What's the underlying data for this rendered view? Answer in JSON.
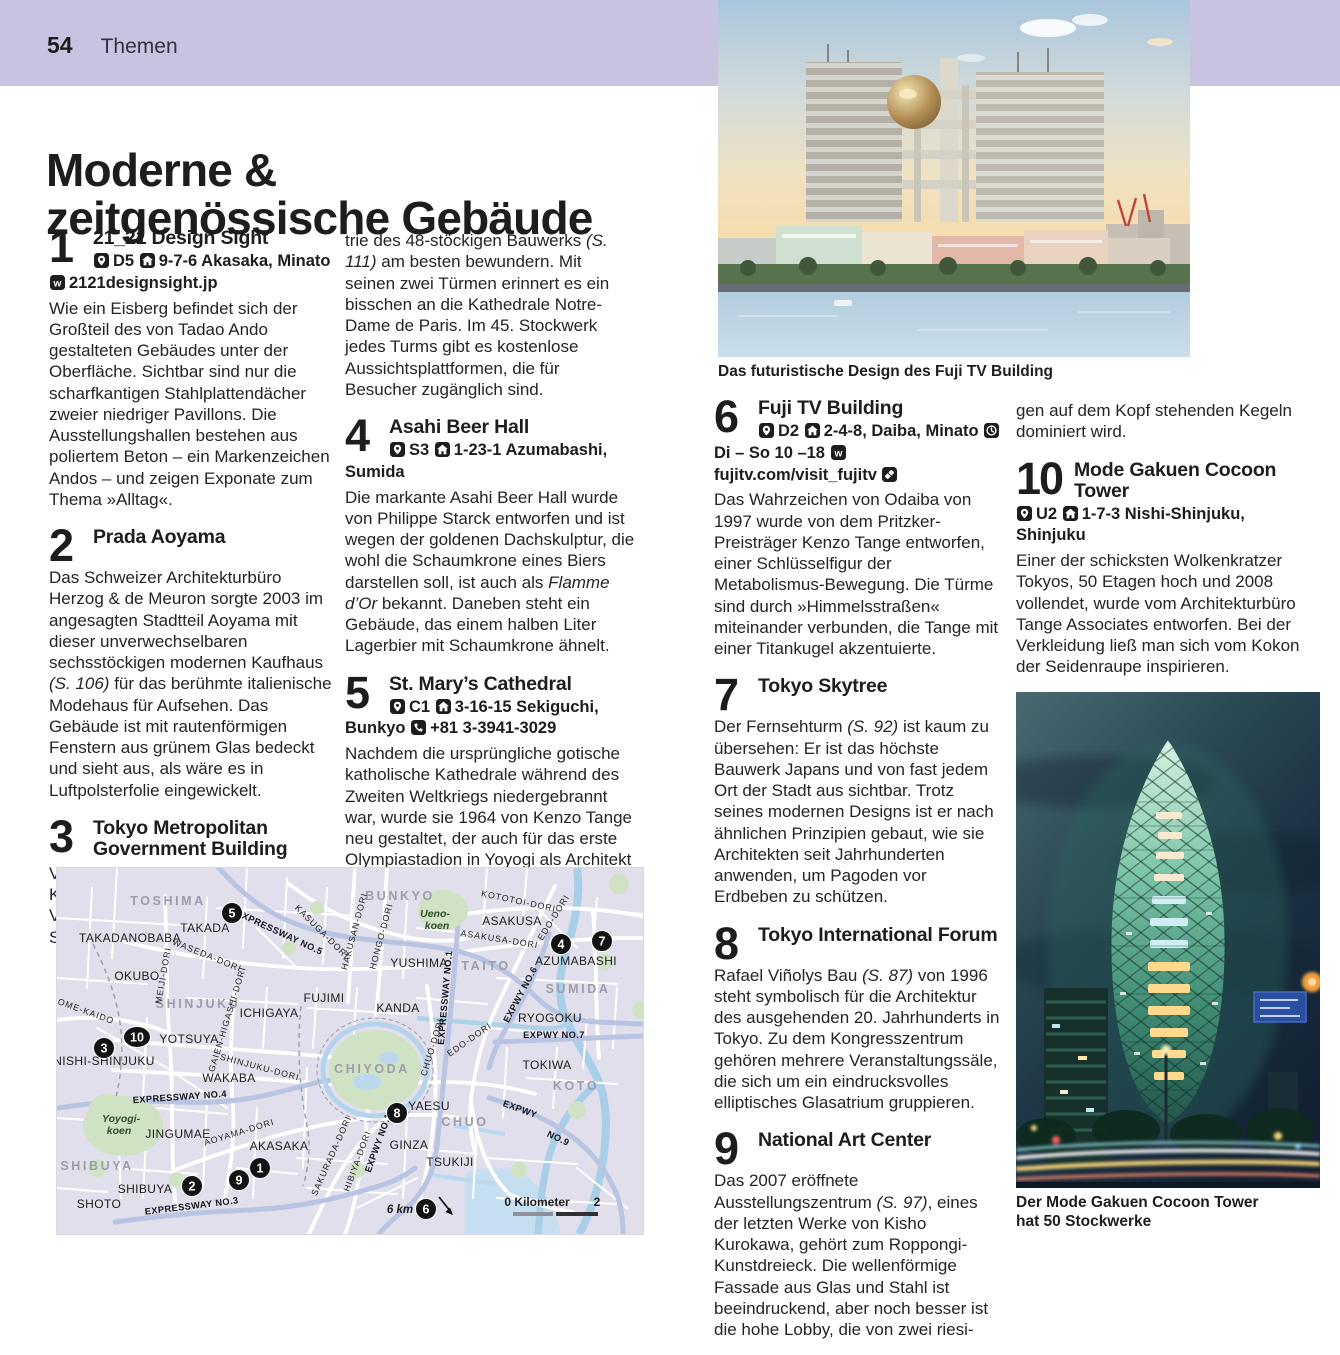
{
  "header": {
    "page_number": "54",
    "section_label": "Themen"
  },
  "title": {
    "line1": "Moderne &",
    "line2": "zeitgenössische Gebäude"
  },
  "captions": {
    "photo1": "Das futuristische Design des Fuji TV Building",
    "photo2": "Der Mode Gakuen Cocoon Tower hat 50 Stockwerke"
  },
  "colors": {
    "band": "#c9c3e2",
    "text": "#1d1d1b",
    "map_background": "#e0dfeb",
    "map_park": "#cfe3c4",
    "map_water": "#a9cfe8",
    "map_expressway": "#b9c4e2",
    "map_road": "#ffffff",
    "marker": "#131313"
  },
  "entries": {
    "e1": {
      "number": "1",
      "title": "21_21 Design Sight",
      "info": [
        {
          "icon": "map-pin-icon",
          "text": "D5"
        },
        {
          "icon": "house-icon",
          "text": "9-7-6 Akasaka, Minato"
        },
        {
          "icon": "web-icon",
          "text": "2121designsight.jp"
        }
      ],
      "body": "Wie ein Eisberg befindet sich der Großteil des von Tadao Ando gestalteten Gebäudes unter der Oberfläche. Sichtbar sind nur die scharfkantigen Stahlplattendächer zweier niedriger Pavillons. Die Ausstellungshallen bestehen aus poliertem Beton – ein Markenzeichen Andos – und zeigen Exponate zum Thema »Alltag«."
    },
    "e2": {
      "number": "2",
      "title": "Prada Aoyama",
      "body": "Das Schweizer Architekturbüro Herzog & de Meuron sorgte 2003 im angesagten Stadtteil Aoyama mit dieser unverwechselbaren sechsstöckigen modernen Kaufhaus (S. 106) für das berühmte italienische Modehaus für Aufsehen. Das Gebäude ist mit rautenförmigen Fenstern aus grünem Glas bedeckt und sieht aus, als wäre es in Luftpolsterfolie eingewickelt."
    },
    "e3": {
      "number": "3",
      "title": "Tokyo Metropolitan Government Building",
      "body": "Vom Rand der Plaza vor dem von Kenzo Tange entworfenen Verwaltungsgebäude lässt sich die Symme-"
    },
    "cont2": "trie des 48-stöckigen Bauwerks (S. 111) am besten bewundern. Mit seinen zwei Türmen erinnert es ein bisschen an die Kathedrale Notre-Dame de Paris. Im 45. Stockwerk jedes Turms gibt es kostenlose Aussichtsplattformen, die für Besucher zugänglich sind.",
    "e4": {
      "number": "4",
      "title": "Asahi Beer Hall",
      "info": [
        {
          "icon": "map-pin-icon",
          "text": "S3"
        },
        {
          "icon": "house-icon",
          "text": "1-23-1 Azumabashi, Sumida"
        }
      ],
      "body": "Die markante Asahi Beer Hall wurde von Philippe Starck entworfen und ist wegen der goldenen Dachskulptur, die wohl die Schaumkrone eines Biers darstellen soll, ist auch als Flamme d’Or bekannt. Daneben steht ein Gebäude, das einem halben Liter Lagerbier mit Schaumkrone ähnelt."
    },
    "e5": {
      "number": "5",
      "title": "St. Mary’s Cathedral",
      "info": [
        {
          "icon": "map-pin-icon",
          "text": "C1"
        },
        {
          "icon": "house-icon",
          "text": "3-16-15 Sekiguchi, Bunkyo"
        },
        {
          "icon": "phone-icon",
          "text": "+81 3-3941-3029"
        }
      ],
      "body": "Nachdem die ursprüngliche gotische katholische Kathedrale während des Zweiten Weltkriegs niedergebrannt war, wurde sie 1964 von Kenzo Tange neu gestaltet, der auch für das erste Olympiastadion in Yoyogi als Architekt verantwortlich zeichnete."
    },
    "e6": {
      "number": "6",
      "title": "Fuji TV Building",
      "info": [
        {
          "icon": "map-pin-icon",
          "text": "D2"
        },
        {
          "icon": "house-icon",
          "text": "2-4-8, Daiba, Minato"
        },
        {
          "icon": "clock-icon",
          "text": "Di – So 10 –18"
        },
        {
          "icon": "web-icon",
          "text": "fujitv.com/visit_fujitv"
        },
        {
          "icon": "ticket-icon",
          "text": ""
        }
      ],
      "body": "Das Wahrzeichen von Odaiba von 1997 wurde von dem Pritzker-Preisträger Kenzo Tange entworfen, einer Schlüsselfigur der Metabolismus-Bewegung. Die Türme sind durch »Himmelsstraßen« miteinander verbunden, die Tange mit einer Titankugel akzentuierte."
    },
    "e7": {
      "number": "7",
      "title": "Tokyo Skytree",
      "body": "Der Fernsehturm (S. 92) ist kaum zu übersehen: Er ist das höchste Bauwerk Japans und von fast jedem Ort der Stadt aus sichtbar. Trotz seines modernen Designs ist er nach ähnlichen Prinzipien gebaut, wie sie Architekten seit Jahrhunderten anwenden, um Pagoden vor Erdbeben zu schützen."
    },
    "e8": {
      "number": "8",
      "title": "Tokyo International Forum",
      "body": "Rafael Viñolys Bau (S. 87) von 1996 steht symbolisch für die Architektur des ausgehenden 20. Jahrhunderts in Tokyo. Zu dem Kongresszentrum gehören mehrere Veranstaltungssäle, die sich um ein eindrucksvolles elliptisches Glasatrium gruppieren."
    },
    "e9": {
      "number": "9",
      "title": "National Art Center",
      "body": "Das 2007 eröffnete Ausstellungszentrum (S. 97), eines der letzten Werke von Kisho Kurokawa, gehört zum Roppongi-Kunstdreieck. Die wellenförmige Fassade aus Glas und Stahl ist beeindruckend, aber noch besser ist die hohe Lobby, die von zwei riesi-"
    },
    "cont4": "gen auf dem Kopf stehenden Kegeln dominiert wird.",
    "e10": {
      "number": "10",
      "title": "Mode Gakuen Cocoon Tower",
      "info": [
        {
          "icon": "map-pin-icon",
          "text": "U2"
        },
        {
          "icon": "house-icon",
          "text": "1-7-3 Nishi-Shinjuku, Shinjuku"
        }
      ],
      "body": "Einer der schicksten Wolkenkratzer Tokyos, 50 Etagen hoch und 2008 vollendet, wurde vom Architekturbüro Tange Associates entworfen. Bei der Verkleidung ließ man sich vom Kokon der Seidenraupe inspirieren."
    }
  },
  "map": {
    "markers": [
      {
        "n": "1",
        "x": 203,
        "y": 300
      },
      {
        "n": "2",
        "x": 135,
        "y": 318
      },
      {
        "n": "3",
        "x": 47,
        "y": 180
      },
      {
        "n": "4",
        "x": 504,
        "y": 76
      },
      {
        "n": "5",
        "x": 175,
        "y": 45
      },
      {
        "n": "6",
        "x": 369,
        "y": 341
      },
      {
        "n": "7",
        "x": 545,
        "y": 73
      },
      {
        "n": "8",
        "x": 340,
        "y": 245
      },
      {
        "n": "9",
        "x": 182,
        "y": 312
      },
      {
        "n": "10",
        "x": 80,
        "y": 169
      }
    ],
    "labels": [
      {
        "text": "TOSHIMA",
        "type": "district",
        "x": 111,
        "y": 37,
        "r": 0
      },
      {
        "text": "BUNKYO",
        "type": "district",
        "x": 343,
        "y": 32,
        "r": 0
      },
      {
        "text": "SHINJUKU",
        "type": "district",
        "x": 141,
        "y": 140,
        "r": 0
      },
      {
        "text": "TAITO",
        "type": "district",
        "x": 429,
        "y": 102,
        "r": 0
      },
      {
        "text": "SUMIDA",
        "type": "district",
        "x": 521,
        "y": 125,
        "r": 0
      },
      {
        "text": "CHIYODA",
        "type": "district",
        "x": 315,
        "y": 205,
        "r": 0
      },
      {
        "text": "SHIBUYA",
        "type": "district",
        "x": 40,
        "y": 302,
        "r": 0
      },
      {
        "text": "CHUO",
        "type": "district",
        "x": 408,
        "y": 258,
        "r": 0
      },
      {
        "text": "KOTO",
        "type": "district",
        "x": 519,
        "y": 222,
        "r": 0
      },
      {
        "text": "TAKADANOBABA",
        "type": "place",
        "x": 73,
        "y": 74,
        "r": 0
      },
      {
        "text": "TAKADA",
        "type": "place",
        "x": 148,
        "y": 64,
        "r": 0
      },
      {
        "text": "OKUBO",
        "type": "place",
        "x": 80,
        "y": 112,
        "r": 0
      },
      {
        "text": "YUSHIMA",
        "type": "place",
        "x": 362,
        "y": 99,
        "r": 0
      },
      {
        "text": "ASAKUSA",
        "type": "place",
        "x": 455,
        "y": 57,
        "r": 0
      },
      {
        "text": "AZUMABASHI",
        "type": "place",
        "x": 519,
        "y": 97,
        "r": 0
      },
      {
        "text": "KANDA",
        "type": "place",
        "x": 341,
        "y": 144,
        "r": 0
      },
      {
        "text": "RYOGOKU",
        "type": "place",
        "x": 493,
        "y": 154,
        "r": 0
      },
      {
        "text": "NISHI-SHINJUKU",
        "type": "place",
        "x": 47,
        "y": 197,
        "r": 0
      },
      {
        "text": "ICHIGAYA",
        "type": "place",
        "x": 212,
        "y": 149,
        "r": 0
      },
      {
        "text": "FUJIMI",
        "type": "place",
        "x": 267,
        "y": 134,
        "r": 0
      },
      {
        "text": "YOTSUYA",
        "type": "place",
        "x": 132,
        "y": 175,
        "r": 0
      },
      {
        "text": "WAKABA",
        "type": "place",
        "x": 172,
        "y": 214,
        "r": 0
      },
      {
        "text": "JINGUMAE",
        "type": "place",
        "x": 121,
        "y": 270,
        "r": 0
      },
      {
        "text": "AKASAKA",
        "type": "place",
        "x": 222,
        "y": 282,
        "r": 0
      },
      {
        "text": "SHIBUYA",
        "type": "place",
        "x": 88,
        "y": 325,
        "r": 0
      },
      {
        "text": "SHOTO",
        "type": "place",
        "x": 42,
        "y": 340,
        "r": 0
      },
      {
        "text": "YAESU",
        "type": "place",
        "x": 372,
        "y": 242,
        "r": 0
      },
      {
        "text": "GINZA",
        "type": "place",
        "x": 352,
        "y": 281,
        "r": 0
      },
      {
        "text": "TSUKIJI",
        "type": "place",
        "x": 393,
        "y": 298,
        "r": 0
      },
      {
        "text": "TOKIWA",
        "type": "place",
        "x": 490,
        "y": 201,
        "r": 0
      },
      {
        "text": "Ueno-",
        "type": "park",
        "x": 378,
        "y": 49,
        "r": 0
      },
      {
        "text": "koen",
        "type": "park",
        "x": 380,
        "y": 61,
        "r": 0
      },
      {
        "text": "Yoyogi-",
        "type": "park",
        "x": 64,
        "y": 254,
        "r": 0
      },
      {
        "text": "koen",
        "type": "park",
        "x": 62,
        "y": 266,
        "r": 0
      },
      {
        "text": "WASEDA-DORI",
        "type": "road",
        "x": 149,
        "y": 90,
        "r": 22
      },
      {
        "text": "KASUGA-DORI",
        "type": "road",
        "x": 263,
        "y": 66,
        "r": 45
      },
      {
        "text": "HAKUSAN-DORI",
        "type": "road",
        "x": 300,
        "y": 64,
        "r": -75
      },
      {
        "text": "HONGO-DORI",
        "type": "road",
        "x": 327,
        "y": 69,
        "r": -75
      },
      {
        "text": "KOTOTOI-DORI",
        "type": "road",
        "x": 461,
        "y": 36,
        "r": 12
      },
      {
        "text": "ASAKUSA-DORI",
        "type": "road",
        "x": 442,
        "y": 74,
        "r": 9
      },
      {
        "text": "EDO-DORI",
        "type": "road",
        "x": 499,
        "y": 51,
        "r": -58
      },
      {
        "text": "MEIJI-DORI",
        "type": "road",
        "x": 109,
        "y": 108,
        "r": -80
      },
      {
        "text": "OME-KAIDO",
        "type": "road",
        "x": 28,
        "y": 146,
        "r": 20
      },
      {
        "text": "GAIEN-HIGASHI-DORI",
        "type": "road",
        "x": 173,
        "y": 152,
        "r": -73
      },
      {
        "text": "SHINJUKU-DORI",
        "type": "road",
        "x": 202,
        "y": 202,
        "r": 15
      },
      {
        "text": "AOYAMA-DORI",
        "type": "road",
        "x": 183,
        "y": 267,
        "r": -17
      },
      {
        "text": "SAKURADA-DORI",
        "type": "road",
        "x": 277,
        "y": 289,
        "r": -66
      },
      {
        "text": "HIBIYA-DORI",
        "type": "road",
        "x": 303,
        "y": 294,
        "r": -70
      },
      {
        "text": "CHUO-DORI",
        "type": "road",
        "x": 378,
        "y": 180,
        "r": -73
      },
      {
        "text": "EDO-DORI",
        "type": "road",
        "x": 414,
        "y": 174,
        "r": -35
      },
      {
        "text": "EXPRESSWAY NO.5",
        "type": "expwy",
        "x": 221,
        "y": 67,
        "r": 25
      },
      {
        "text": "EXPRESSWAY NO.1",
        "type": "expwy",
        "x": 391,
        "y": 130,
        "r": -85
      },
      {
        "text": "EXPRESSWAY NO.4",
        "type": "expwy",
        "x": 123,
        "y": 232,
        "r": -4
      },
      {
        "text": "EXPRESSWAY NO.3",
        "type": "expwy",
        "x": 135,
        "y": 341,
        "r": -7
      },
      {
        "text": "EXPWY NO.6",
        "type": "expwy",
        "x": 466,
        "y": 128,
        "r": -62
      },
      {
        "text": "EXPWY NO.7",
        "type": "expwy",
        "x": 497,
        "y": 170,
        "r": 0
      },
      {
        "text": "EXPWY",
        "type": "expwy",
        "x": 462,
        "y": 244,
        "r": 20
      },
      {
        "text": "NO.9",
        "type": "expwy",
        "x": 500,
        "y": 273,
        "r": 25
      },
      {
        "text": "EXPWY NO.1",
        "type": "expwy",
        "x": 324,
        "y": 276,
        "r": -70
      },
      {
        "text": "0 Kilometer",
        "type": "scale",
        "x": 480,
        "y": 338,
        "r": 0
      },
      {
        "text": "2",
        "type": "scale",
        "x": 540,
        "y": 338,
        "r": 0
      },
      {
        "text": "6 km",
        "type": "kmnote",
        "x": 343,
        "y": 345,
        "r": 0
      }
    ]
  }
}
